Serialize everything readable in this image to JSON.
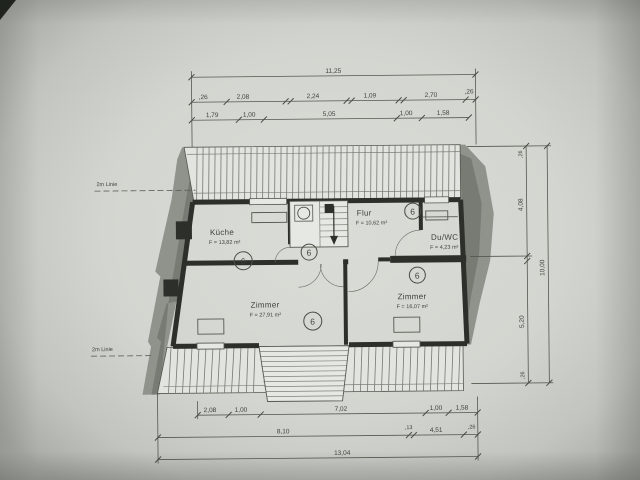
{
  "drawing": {
    "rooms": [
      {
        "name": "Küche",
        "area": "F = 13,82 m²",
        "number": "6"
      },
      {
        "name": "Flur",
        "area": "F = 10,62 m²",
        "number": "6"
      },
      {
        "name": "Du/WC",
        "area": "F = 4,23 m²",
        "number": "6"
      },
      {
        "name": "Zimmer",
        "area": "F = 27,91 m²",
        "number": "6"
      },
      {
        "name": "Zimmer",
        "area": "F = 16,07 m²",
        "number": "6"
      }
    ],
    "hall_number": "6",
    "height_lines": {
      "top": "2m Linie",
      "bottom": "2m Linie"
    },
    "dims": {
      "top_total": "11,25",
      "top_row2": [
        ",26",
        "2,08",
        "2,24",
        "1,09",
        "2,70",
        ",26"
      ],
      "top_row3": [
        "1,79",
        "1,00",
        "5,05",
        "1,00",
        "1,58"
      ],
      "bottom_row1": [
        "2,08",
        "1,00",
        "7,02",
        "1,00",
        "1,58"
      ],
      "bottom_row2": [
        "8,10",
        ",13",
        "4,51",
        ",26"
      ],
      "bottom_total": "13,04",
      "right_col": [
        ",26",
        "4,08",
        "5,20",
        ",26"
      ],
      "right_total": "10,00"
    },
    "colors": {
      "paper": "#d7d9d4",
      "ink": "#3f423c",
      "wall": "#2d2f2a",
      "shade": "#90928c"
    }
  }
}
